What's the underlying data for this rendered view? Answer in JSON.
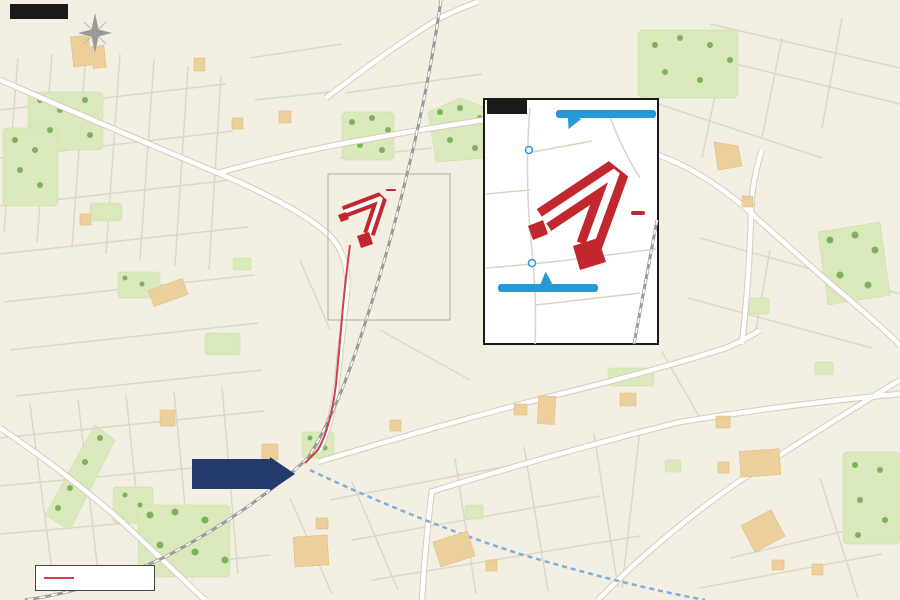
{
  "title": "現地案内図",
  "inset": {
    "label": "拡大図",
    "site_label": "現地",
    "bus_stops": [
      {
        "name": "「若松梅乃郷」",
        "sub": "バス停留所"
      },
      {
        "name": "「西都賀四丁目」",
        "sub": "バス停留所"
      }
    ]
  },
  "site_label": "現地",
  "station": {
    "label": "「都賀」駅"
  },
  "legend": {
    "walk_route": "徒歩ルート"
  },
  "compass": {
    "north": "N"
  },
  "colors": {
    "bg": "#f3efe2",
    "site_red": "#c1272d",
    "route_red": "#d2404a",
    "balloon_blue": "#2798d6",
    "station_navy": "#233a6d",
    "road_sign_blue": "#3f74ad",
    "park_green": "#d9e9bb",
    "building_tan": "#eccf9b",
    "monorail_blue": "#7fb0dc",
    "jr_gray": "#9a9a9a",
    "badge_blue": "#3a67c4"
  },
  "pois": [
    {
      "t": "みつわ台\n総合病院",
      "x": 85,
      "y": 68
    },
    {
      "t": "千葉聖心保育園",
      "x": 212,
      "y": 68
    },
    {
      "t": "若松第8公園",
      "x": 388,
      "y": 16
    },
    {
      "t": "和良比グラウンド",
      "x": 580,
      "y": 67
    },
    {
      "t": "若松\n第二グラウンド",
      "x": 672,
      "y": 74
    },
    {
      "t": "皆照寺",
      "x": 801,
      "y": 73
    },
    {
      "t": "若台第4公園",
      "x": 823,
      "y": 117
    },
    {
      "t": "千葉家畜市場",
      "x": 727,
      "y": 139
    },
    {
      "t": "都賀の台公園",
      "x": 66,
      "y": 118
    },
    {
      "t": "セブン・イレブン",
      "x": 220,
      "y": 126
    },
    {
      "t": "サンドラッグ",
      "x": 291,
      "y": 131
    },
    {
      "t": "若都公園",
      "x": 172,
      "y": 139
    },
    {
      "t": "若松町公園",
      "x": 370,
      "y": 131
    },
    {
      "t": "廣松都賀\nサッカー場",
      "x": 458,
      "y": 141
    },
    {
      "t": "若松第7公園",
      "x": 451,
      "y": 168
    },
    {
      "t": "都賀の台\n小学校",
      "x": 31,
      "y": 161
    },
    {
      "t": "都賀の台\n保育所",
      "x": 101,
      "y": 164
    },
    {
      "t": "小児科\n勝俣医院",
      "x": 46,
      "y": 190
    },
    {
      "t": "都賀の台\n3丁目公園",
      "x": 112,
      "y": 195
    },
    {
      "t": "都賀の台幼稚園",
      "x": 174,
      "y": 189
    },
    {
      "t": "セブン・イレブン",
      "x": 116,
      "y": 227
    },
    {
      "t": "池田歯科医院",
      "x": 39,
      "y": 240
    },
    {
      "t": "石窯パン工房",
      "x": 148,
      "y": 254
    },
    {
      "t": "小林歯科\nクリニック",
      "x": 216,
      "y": 252
    },
    {
      "t": "高品台公園",
      "x": 241,
      "y": 270
    },
    {
      "t": "都賀の台\n1丁目公園",
      "x": 41,
      "y": 290
    },
    {
      "t": "都賀の台\n4丁目公園",
      "x": 133,
      "y": 291
    },
    {
      "t": "ランドローム\nフードマーケット",
      "x": 194,
      "y": 309
    },
    {
      "t": "小山内科",
      "x": 233,
      "y": 320
    },
    {
      "t": "大広公園",
      "x": 219,
      "y": 333
    },
    {
      "t": "中広公園",
      "x": 259,
      "y": 347
    },
    {
      "t": "ツクモデンキ",
      "x": 80,
      "y": 353
    },
    {
      "t": "千葉内科\nクリニック",
      "x": 128,
      "y": 383
    },
    {
      "t": "マミー&ミー\n都賀保育園",
      "x": 263,
      "y": 383
    },
    {
      "t": "キッズマール\n保育園",
      "x": 256,
      "y": 411
    },
    {
      "t": "西都賀\n中央公園",
      "x": 139,
      "y": 411
    },
    {
      "t": "原町さくら\n公園",
      "x": 51,
      "y": 436
    },
    {
      "t": "若葉図書館\n西都賀分館",
      "x": 91,
      "y": 438
    },
    {
      "t": "西友",
      "x": 171,
      "y": 428
    },
    {
      "t": "京葉銀行",
      "x": 208,
      "y": 437
    },
    {
      "t": "千葉信用金庫",
      "x": 176,
      "y": 453
    },
    {
      "t": "原町第1緑地",
      "x": 63,
      "y": 477
    },
    {
      "t": "原町第2緑地",
      "x": 66,
      "y": 503
    },
    {
      "t": "上林間公園",
      "x": 131,
      "y": 507
    },
    {
      "t": "都賀レディース\nクリニック",
      "x": 126,
      "y": 543
    },
    {
      "t": "美しの森公園",
      "x": 208,
      "y": 557
    },
    {
      "t": "松波歯科医院",
      "x": 246,
      "y": 530
    },
    {
      "t": "千葉銀行",
      "x": 262,
      "y": 512
    },
    {
      "t": "ビッグ・エー",
      "x": 298,
      "y": 458
    },
    {
      "t": "ミルキーホーム\n都賀園",
      "x": 344,
      "y": 433
    },
    {
      "t": "都賀\n東公園",
      "x": 354,
      "y": 452
    },
    {
      "t": "都賀駅前\n郵便局",
      "x": 341,
      "y": 478
    },
    {
      "t": "しまむら",
      "x": 386,
      "y": 505
    },
    {
      "t": "内田\n耳鼻咽喉科",
      "x": 337,
      "y": 532
    },
    {
      "t": "マルエツ",
      "x": 318,
      "y": 567
    },
    {
      "t": "都賀せいわ保育園",
      "x": 352,
      "y": 586
    },
    {
      "t": "みのり\n幼稚園",
      "x": 431,
      "y": 397
    },
    {
      "t": "セブン・\nイレブン",
      "x": 396,
      "y": 414
    },
    {
      "t": "都賀保育園",
      "x": 421,
      "y": 441
    },
    {
      "t": "ローソン100",
      "x": 512,
      "y": 396
    },
    {
      "t": "ローソン",
      "x": 511,
      "y": 425
    },
    {
      "t": "都賀\nスポーツセンター",
      "x": 551,
      "y": 437
    },
    {
      "t": "みつばち\n保育園若葉",
      "x": 463,
      "y": 468
    },
    {
      "t": "桜木\n第2公園",
      "x": 528,
      "y": 463
    },
    {
      "t": "桜木第5公園",
      "x": 488,
      "y": 502
    },
    {
      "t": "桜木第6公園",
      "x": 566,
      "y": 502
    },
    {
      "t": "桜木北公園",
      "x": 604,
      "y": 378
    },
    {
      "t": "やまや",
      "x": 635,
      "y": 410
    },
    {
      "t": "都賀\nコミュニティセンター",
      "x": 453,
      "y": 521
    },
    {
      "t": "若葉区役所",
      "x": 492,
      "y": 551
    },
    {
      "t": "若葉保健福祉センター",
      "x": 438,
      "y": 578
    },
    {
      "t": "セブン・イレブン",
      "x": 523,
      "y": 568
    },
    {
      "t": "中尾台公園",
      "x": 586,
      "y": 577
    },
    {
      "t": "セブン・\nイレブン",
      "x": 748,
      "y": 206
    },
    {
      "t": "ファミリー\nマート",
      "x": 758,
      "y": 225
    },
    {
      "t": "若松小学校",
      "x": 856,
      "y": 260
    },
    {
      "t": "若松公園",
      "x": 758,
      "y": 315
    },
    {
      "t": "若松第2公園",
      "x": 821,
      "y": 379
    },
    {
      "t": "ファミリーマート",
      "x": 768,
      "y": 429
    },
    {
      "t": "若松第5公園",
      "x": 861,
      "y": 438
    },
    {
      "t": "セブン・イレブン",
      "x": 728,
      "y": 459
    },
    {
      "t": "若松第1公園",
      "x": 679,
      "y": 473
    },
    {
      "t": "篠崎病院",
      "x": 800,
      "y": 480
    },
    {
      "t": "若松中学校",
      "x": 866,
      "y": 476
    },
    {
      "t": "マクドナルド",
      "x": 779,
      "y": 500
    },
    {
      "t": "ロイヤル\nホームセンター",
      "x": 741,
      "y": 537
    },
    {
      "t": "さとうクリニック",
      "x": 711,
      "y": 560
    },
    {
      "t": "マツモトキヨシ",
      "x": 766,
      "y": 570
    },
    {
      "t": "セブン・イレブン",
      "x": 829,
      "y": 570
    },
    {
      "t": "小倉町第4公園",
      "x": 704,
      "y": 579
    }
  ],
  "way_labels": [
    {
      "t": "御成街道",
      "x": 247,
      "y": 156,
      "r": 88
    },
    {
      "t": "至四街道",
      "x": 339,
      "y": 92,
      "r": 88
    },
    {
      "t": "JR総武本線",
      "x": 428,
      "y": 90,
      "r": 84
    },
    {
      "t": "JR総武本線",
      "x": 646,
      "y": 300,
      "r": 75
    },
    {
      "t": "千葉都市モノレール",
      "x": 352,
      "y": 507,
      "r": 26
    },
    {
      "t": "若葉北通り",
      "x": 556,
      "y": 397,
      "r": -12
    },
    {
      "t": "佐倉街道北通",
      "x": 778,
      "y": 409,
      "r": -6
    },
    {
      "t": "北千葉バイパス",
      "x": 792,
      "y": 441,
      "r": -37
    },
    {
      "t": "北千葉バイパス",
      "x": 668,
      "y": 540,
      "r": -42
    }
  ],
  "road_signs": [
    {
      "t": "都賀駅西口入口",
      "x": 84,
      "y": 459
    },
    {
      "t": "小倉台入口",
      "x": 707,
      "y": 488
    },
    {
      "t": "若葉区役所",
      "x": 424,
      "y": 557
    },
    {
      "t": "都賀駅",
      "x": 277,
      "y": 494
    },
    {
      "t": "跨線橋",
      "x": 68,
      "y": 546
    }
  ],
  "direction_labels": [
    {
      "t": "至成田",
      "x": 465,
      "y": 10,
      "c": "dark"
    },
    {
      "t": "至千城台",
      "x": 517,
      "y": 586
    },
    {
      "t": "至千葉",
      "x": 137,
      "y": 586
    },
    {
      "t": "至千葉",
      "x": 13,
      "y": 522,
      "r": 90
    }
  ],
  "route_badges": [
    {
      "n": "64",
      "x": 218,
      "y": 173
    },
    {
      "n": "64",
      "x": 80,
      "y": 522
    },
    {
      "n": "51",
      "x": 816,
      "y": 437
    },
    {
      "n": "51",
      "x": 707,
      "y": 516
    }
  ],
  "dots": [
    [
      88,
      56
    ],
    [
      198,
      68
    ],
    [
      395,
      23
    ],
    [
      585,
      60
    ],
    [
      672,
      59
    ],
    [
      801,
      64
    ],
    [
      838,
      110
    ],
    [
      727,
      147
    ],
    [
      66,
      110
    ],
    [
      236,
      127
    ],
    [
      283,
      124
    ],
    [
      172,
      131
    ],
    [
      370,
      122
    ],
    [
      458,
      128
    ],
    [
      437,
      159
    ],
    [
      30,
      148
    ],
    [
      100,
      152
    ],
    [
      62,
      183
    ],
    [
      213,
      188
    ],
    [
      88,
      218
    ],
    [
      72,
      240
    ],
    [
      178,
      253
    ],
    [
      216,
      240
    ],
    [
      240,
      262
    ],
    [
      103,
      352
    ],
    [
      214,
      318
    ],
    [
      205,
      333
    ],
    [
      245,
      347
    ],
    [
      132,
      371
    ],
    [
      268,
      372
    ],
    [
      167,
      420
    ],
    [
      199,
      437
    ],
    [
      151,
      453
    ],
    [
      273,
      462
    ],
    [
      352,
      444
    ],
    [
      328,
      477
    ],
    [
      403,
      441
    ],
    [
      360,
      505
    ],
    [
      322,
      530
    ],
    [
      340,
      578
    ],
    [
      432,
      412
    ],
    [
      398,
      427
    ],
    [
      495,
      403
    ],
    [
      521,
      415
    ],
    [
      523,
      452
    ],
    [
      467,
      510
    ],
    [
      541,
      510
    ],
    [
      610,
      372
    ],
    [
      630,
      402
    ],
    [
      456,
      551
    ],
    [
      495,
      568
    ],
    [
      608,
      570
    ],
    [
      818,
      567
    ],
    [
      778,
      566
    ],
    [
      750,
      500
    ],
    [
      723,
      466
    ],
    [
      732,
      429
    ],
    [
      850,
      430
    ],
    [
      823,
      370
    ],
    [
      758,
      307
    ],
    [
      858,
      270
    ],
    [
      728,
      212
    ],
    [
      100,
      186
    ],
    [
      245,
      509
    ],
    [
      432,
      515
    ],
    [
      237,
      541
    ]
  ]
}
